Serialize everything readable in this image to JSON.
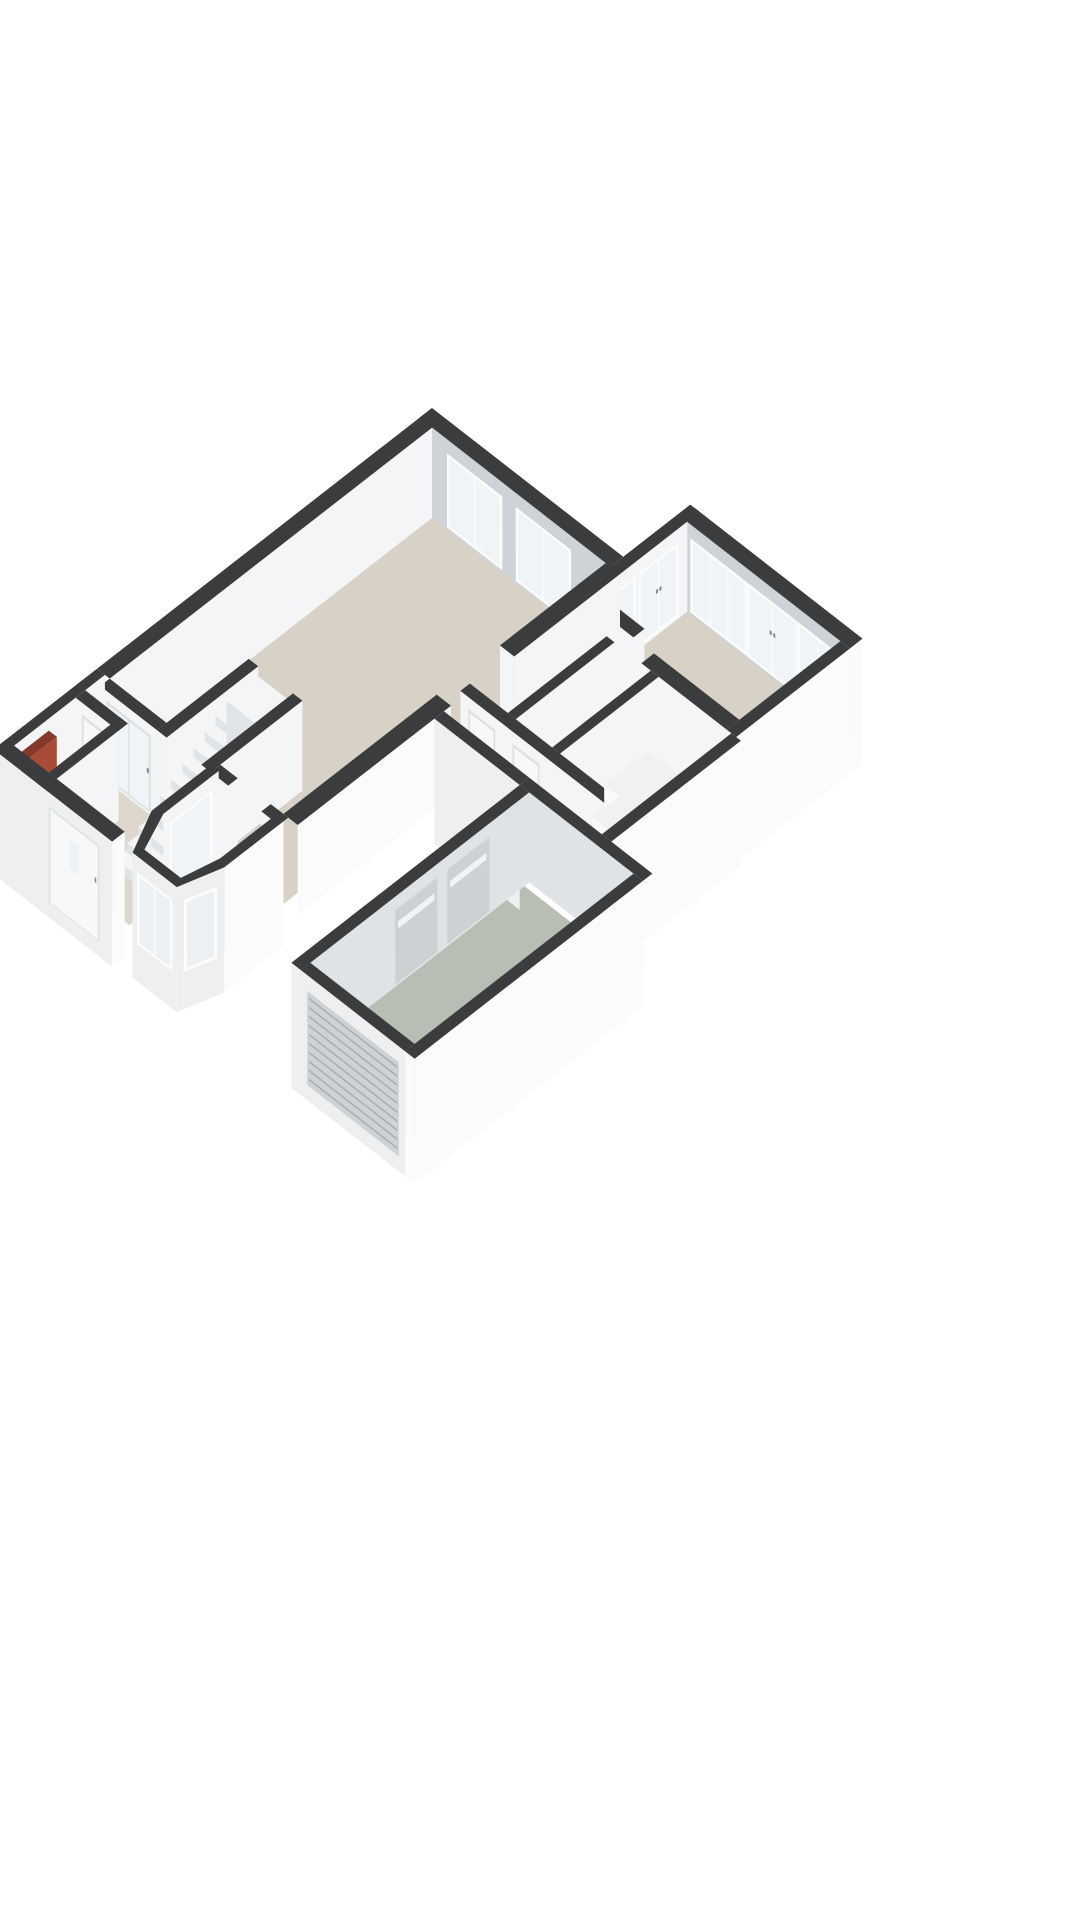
{
  "page": {
    "background": "#ffffff"
  },
  "scene": {
    "type": "isometric-3d-floorplan",
    "colors": {
      "background": "#ffffff",
      "wallTop": "#3a3c3e",
      "intWhite": "#f4f5f6",
      "intGray": "#ced3d7",
      "intLightGray": "#e0e3e5",
      "extSW": "#edeff0",
      "extSE": "#fafbfb",
      "floorBeige": "#d8d1c5",
      "floorHall": "#ddd7cb",
      "floorGray": "#b9beb4",
      "glass": "#f0f4f6",
      "glassExt": "#eef1f3",
      "frame": "#fbfcfd",
      "frameShade": "#d9dcde",
      "doorWhite": "#f7f8f9",
      "doorFrame": "#dde0e2",
      "grayDoor": "#ccd1d4",
      "slatDoor": "#ced2d5",
      "slatLine": "#a6abae",
      "slitWhite": "#f1f3f4",
      "tread": "#f4f5f6",
      "riser": "#e1e4e6",
      "counterTop": "#eff1f2",
      "counterFace": "#fafbfc",
      "red": "#a84c36",
      "redDark": "#84392a",
      "handle": "#85898d"
    }
  }
}
